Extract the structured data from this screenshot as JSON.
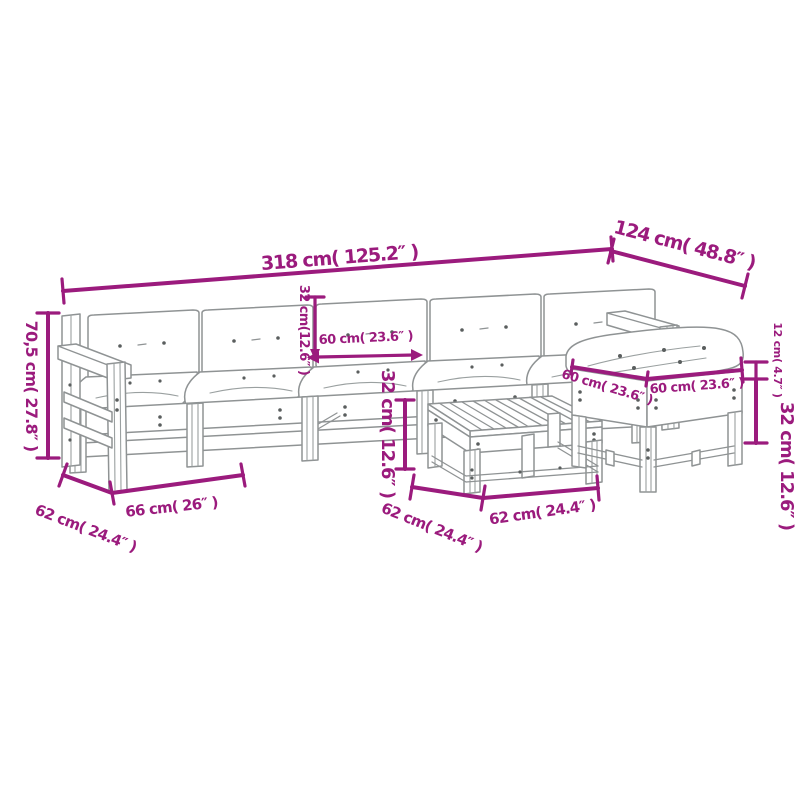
{
  "colors": {
    "dimension_magenta": "#9b1b7d",
    "line_art_gray": "#8f9394",
    "background": "#ffffff"
  },
  "furniture_items": [
    "five-seat-garden-sofa-with-cushions",
    "slatted-coffee-table",
    "footstool-with-cushion"
  ],
  "dims": {
    "sofa_width": "318 cm( 125.2″ )",
    "sofa_depth": "124 cm( 48.8″ )",
    "sofa_height": "70,5 cm( 27.8″ )",
    "armrest_depth": "62 cm( 24.4″ )",
    "seat_module_width": "66 cm( 26″ )",
    "back_cushion_height": "32 cm(12.6″ )",
    "seat_cushion_width": "60 cm( 23.6″ )",
    "table_height": "32 cm( 12.6″ )",
    "table_depth": "62 cm( 24.4″ )",
    "table_width": "62 cm( 24.4″ )",
    "stool_depth": "60 cm( 23.6″ )",
    "stool_width": "60 cm( 23.6″ )",
    "stool_cushion_thickness": "12 cm( 4.7″ )",
    "stool_height": "32 cm( 12.6″ )"
  }
}
